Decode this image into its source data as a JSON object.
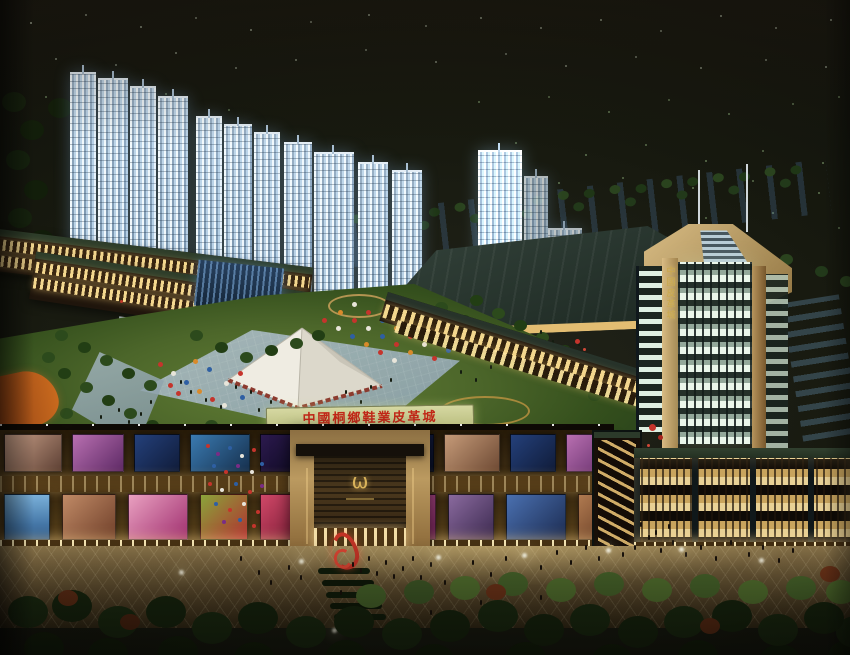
{
  "scene": {
    "title": "Night aerial architectural rendering of a shoes and leather trade city complex",
    "description": "Photographed rendering board: lit shopping mall with billboards in foreground, central lawn plaza with white tent and umbrellas, office tower at right, residential high-rises at upper left, dark city lights behind"
  },
  "labels": {
    "lawn_banner": "中國桐鄉鞋業皮革城",
    "tower_banner": "中國皮革城",
    "entrance_emblem": "ω"
  },
  "palette": {
    "night_sky": "#131511",
    "city_light": "#cfe3c2",
    "residential_glow": "#cfe0ee",
    "lawn_green": "#4f662a",
    "plaza_paving_blue": "#9db6c2",
    "mall_glow": "#e9cf8e",
    "stone_tan": "#c2a368",
    "banner_red": "#c22818",
    "roof_green": "#2f3e2f",
    "water_blue": "#2c4a66",
    "balloon_red": "#c5342c",
    "ramp_orange": "#c96a1e"
  }
}
